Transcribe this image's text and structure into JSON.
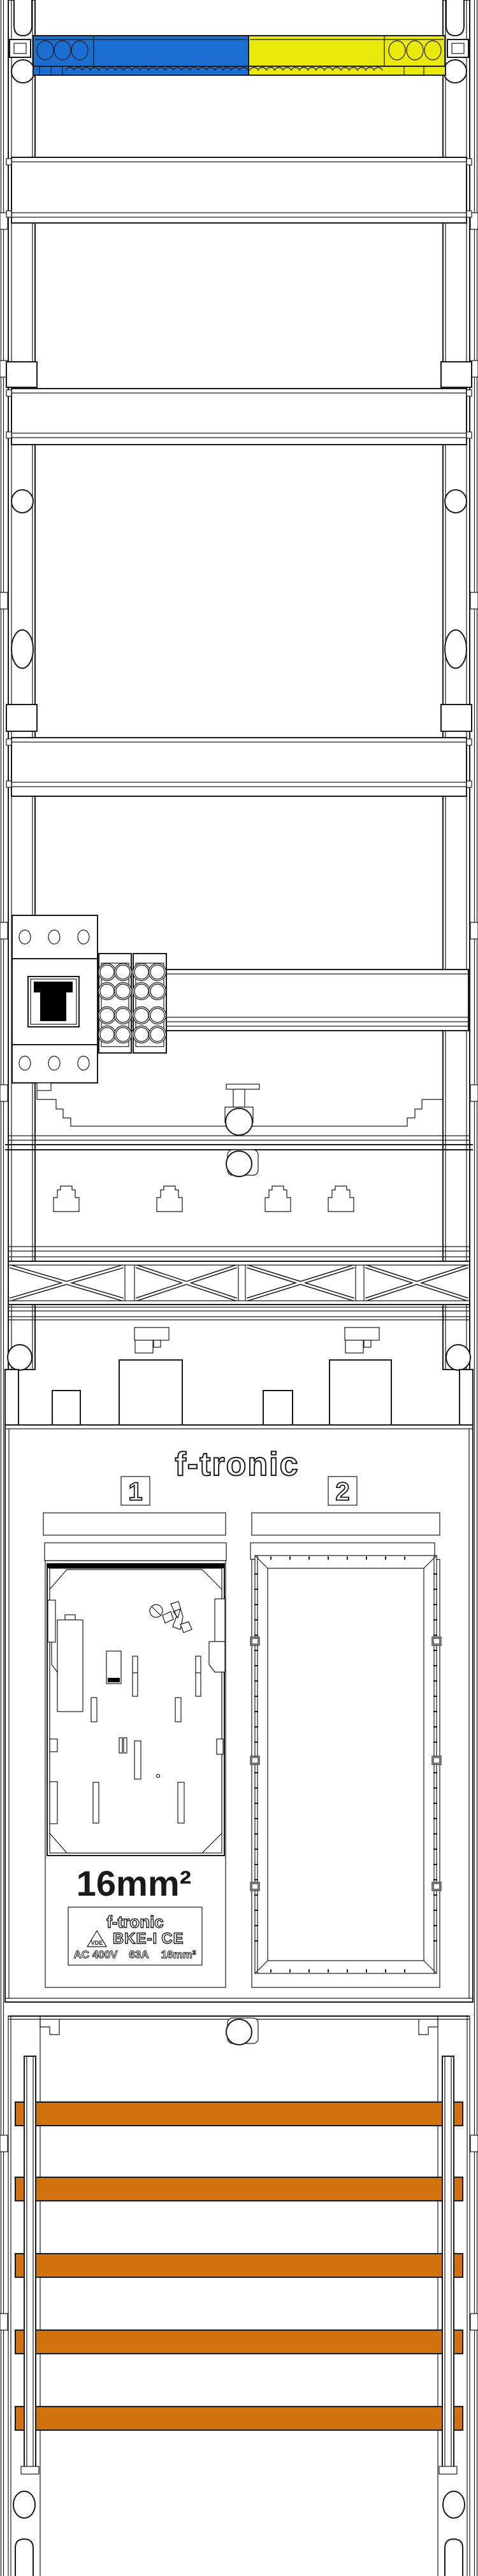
{
  "colors": {
    "background": "#ffffff",
    "line": "#1a1a1a",
    "neutral_blue": "#1c6fd2",
    "pe_yellow": "#e9e90c",
    "busbar_orange": "#d2720e",
    "device_black": "#000000"
  },
  "meter_panel": {
    "brand_logo": "f-tronic",
    "field_1_number": "1",
    "field_2_number": "2",
    "bke_device": {
      "wire_size_label": "16mm²",
      "rating_plate": {
        "brand": "f-tronic",
        "vde_mark": "VDE",
        "model": "BKE-I",
        "ce_mark": "CE",
        "voltage": "AC 400V",
        "current": "63A",
        "cross_section": "16mm²"
      }
    }
  }
}
